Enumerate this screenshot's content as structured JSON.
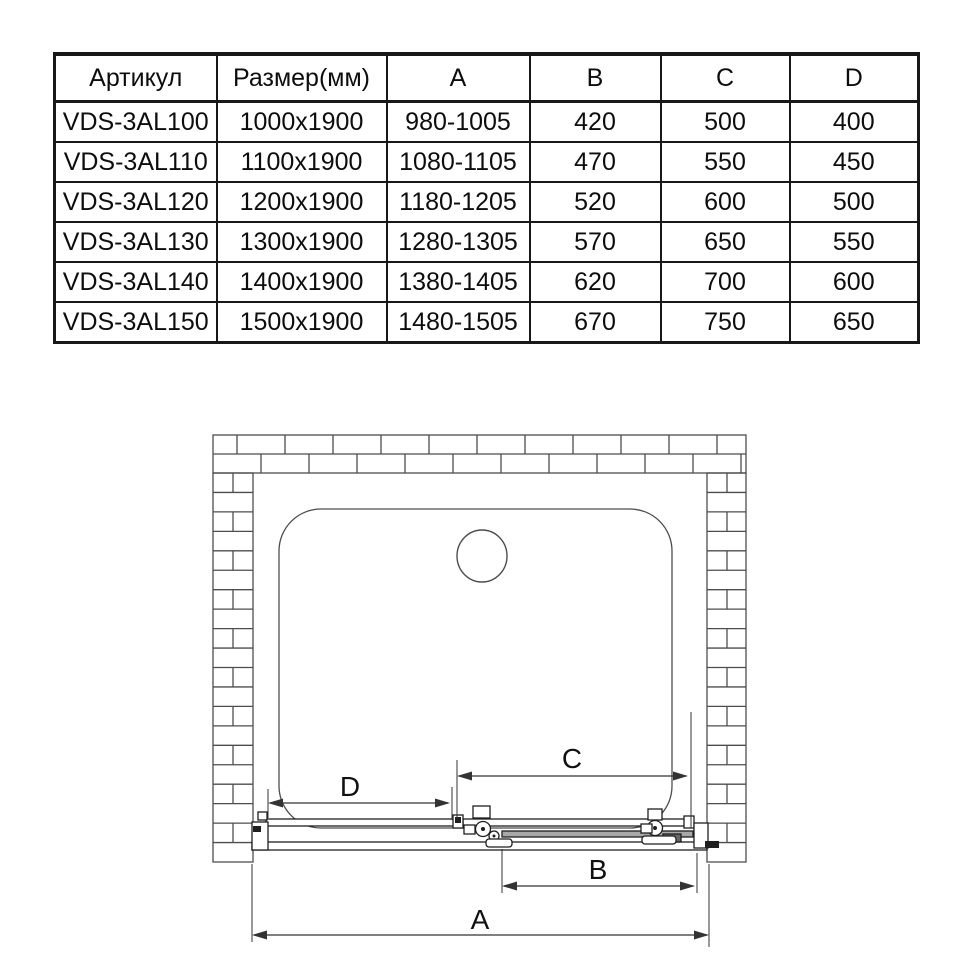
{
  "table": {
    "headers": [
      "Артикул",
      "Размер(мм)",
      "A",
      "B",
      "C",
      "D"
    ],
    "rows": [
      [
        "VDS-3AL100",
        "1000x1900",
        "980-1005",
        "420",
        "500",
        "400"
      ],
      [
        "VDS-3AL110",
        "1100x1900",
        "1080-1105",
        "470",
        "550",
        "450"
      ],
      [
        "VDS-3AL120",
        "1200x1900",
        "1180-1205",
        "520",
        "600",
        "500"
      ],
      [
        "VDS-3AL130",
        "1300x1900",
        "1280-1305",
        "570",
        "650",
        "550"
      ],
      [
        "VDS-3AL140",
        "1400x1900",
        "1380-1405",
        "620",
        "700",
        "600"
      ],
      [
        "VDS-3AL150",
        "1500x1900",
        "1480-1505",
        "670",
        "750",
        "650"
      ]
    ]
  },
  "diagram": {
    "dimension_labels": {
      "A": "A",
      "B": "B",
      "C": "C",
      "D": "D"
    },
    "line_color": "#4d4d4d",
    "dark_color": "#1f1f1f",
    "dim_color": "#333333",
    "text_color": "#111111"
  }
}
